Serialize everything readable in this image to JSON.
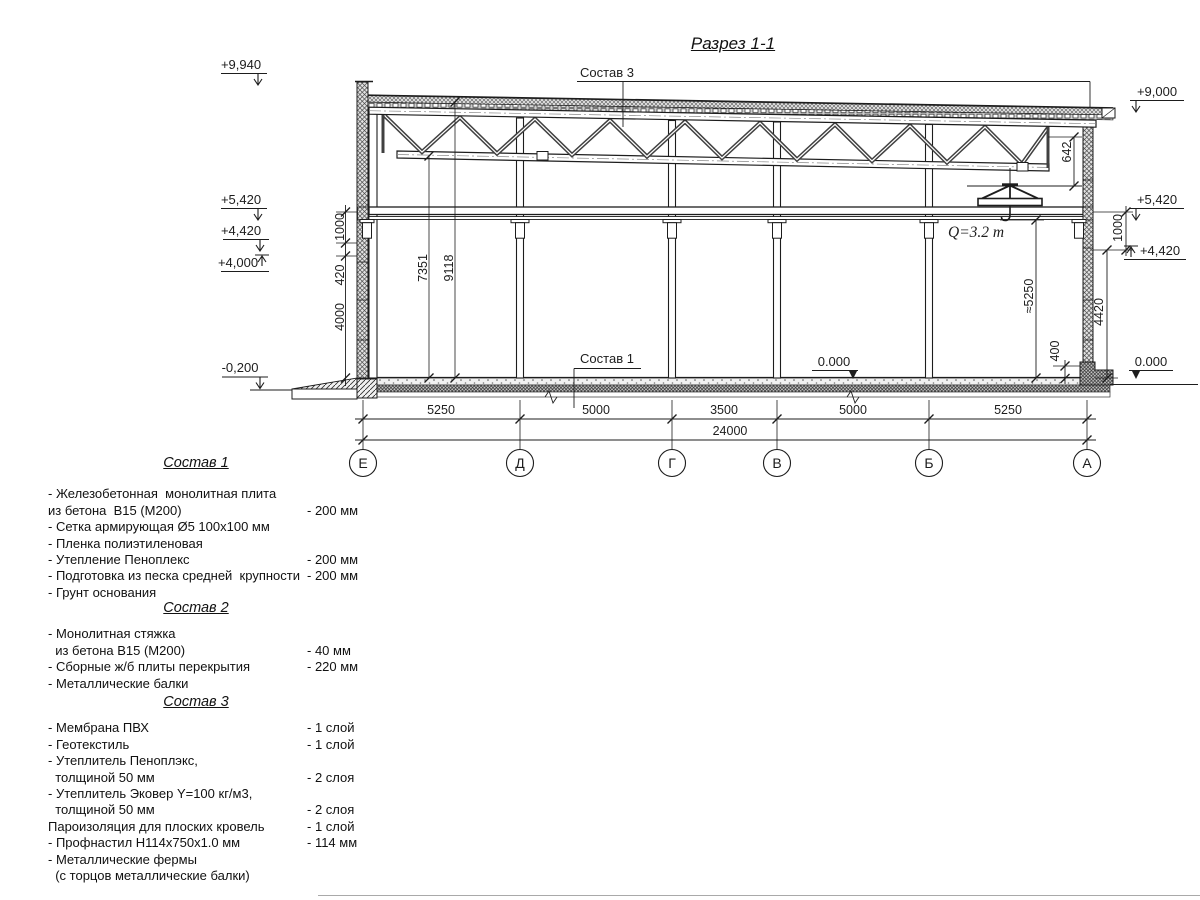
{
  "title": "Разрез 1-1",
  "section": {
    "labels": {
      "sostav3_callout": "Состав 3",
      "sostav1_callout": "Состав 1",
      "crane_capacity": "Q=3.2 т",
      "level_zero_mid": "0.000",
      "level_zero_right": "0.000"
    },
    "elevations": {
      "left": {
        "parapet": "+9,940",
        "beam": "+5,420",
        "e4420": "+4,420",
        "e4000": "+4,000",
        "ground": "-0,200"
      },
      "right": {
        "roof": "+9,000",
        "beam": "+5,420",
        "e4420": "+4,420"
      }
    },
    "dimensions": {
      "vertical_left": [
        "1000",
        "420",
        "4000"
      ],
      "height_to_bottom_chord": "7351",
      "height_to_roof": "9118",
      "truss_end_height": "642",
      "vertical_right": [
        "1000",
        "4420",
        "400"
      ],
      "hook_height": "≈5250",
      "spans": [
        "5250",
        "5000",
        "3500",
        "5000",
        "5250"
      ],
      "total_span": "24000"
    },
    "axes": [
      "Е",
      "Д",
      "Г",
      "В",
      "Б",
      "А"
    ]
  },
  "compositions": [
    {
      "title": "Состав 1",
      "items": [
        {
          "text": "- Железобетонная  монолитная плита",
          "value": ""
        },
        {
          "text": "из бетона  В15 (М200)",
          "value": "- 200 мм"
        },
        {
          "text": "- Сетка армирующая Ø5 100х100 мм",
          "value": ""
        },
        {
          "text": "- Пленка полиэтиленовая",
          "value": ""
        },
        {
          "text": "- Утепление Пеноплекс",
          "value": "- 200 мм"
        },
        {
          "text": "- Подготовка из песка средней  крупности",
          "value": "- 200 мм"
        },
        {
          "text": "- Грунт основания",
          "value": ""
        }
      ]
    },
    {
      "title": "Состав 2",
      "items": [
        {
          "text": "- Монолитная стяжка",
          "value": ""
        },
        {
          "text": "  из бетона В15 (М200)",
          "value": "- 40 мм"
        },
        {
          "text": "- Сборные ж/б плиты перекрытия",
          "value": "- 220 мм"
        },
        {
          "text": "- Металлические балки",
          "value": ""
        }
      ]
    },
    {
      "title": "Состав 3",
      "items": [
        {
          "text": "- Мембрана ПВХ",
          "value": "- 1 слой"
        },
        {
          "text": "- Геотекстиль",
          "value": "- 1 слой"
        },
        {
          "text": "- Утеплитель Пеноплэкс,",
          "value": ""
        },
        {
          "text": "  толщиной 50 мм",
          "value": "- 2 слоя"
        },
        {
          "text": "- Утеплитель Эковер Y=100 кг/м3,",
          "value": ""
        },
        {
          "text": "  толщиной 50 мм",
          "value": "- 2 слоя"
        },
        {
          "text": "Пароизоляция для плоских кровель",
          "value": "- 1 слой"
        },
        {
          "text": "- Профнастил Н114х750х1.0 мм",
          "value": "- 114 мм"
        },
        {
          "text": "- Металлические фермы",
          "value": ""
        },
        {
          "text": "  (с торцов металлические балки)",
          "value": ""
        }
      ]
    }
  ]
}
